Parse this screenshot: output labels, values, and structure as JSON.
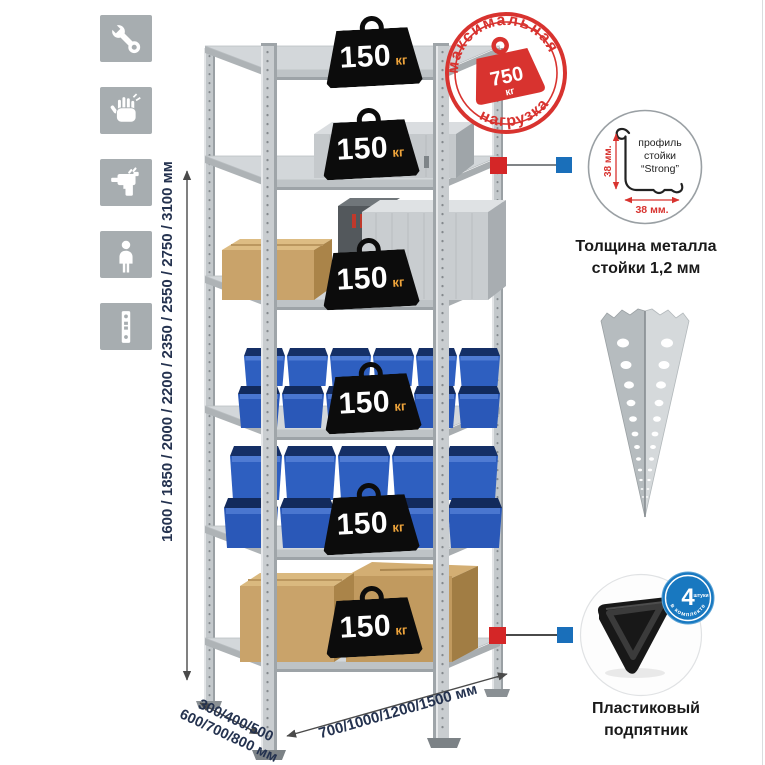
{
  "assembly_icons": [
    {
      "name": "wrench-icon"
    },
    {
      "name": "gloves-icon"
    },
    {
      "name": "drill-icon"
    },
    {
      "name": "person-icon"
    },
    {
      "name": "rack-post-icon"
    }
  ],
  "rack": {
    "shelf_count": 6,
    "shelves": [
      {
        "load_value": "150",
        "load_unit": "кг"
      },
      {
        "load_value": "150",
        "load_unit": "кг"
      },
      {
        "load_value": "150",
        "load_unit": "кг"
      },
      {
        "load_value": "150",
        "load_unit": "кг"
      },
      {
        "load_value": "150",
        "load_unit": "кг"
      },
      {
        "load_value": "150",
        "load_unit": "кг"
      }
    ]
  },
  "max_load_stamp": {
    "arc_top": "максимальная",
    "arc_bottom": "нагрузка",
    "value": "750",
    "unit": "кг"
  },
  "profile_callout": {
    "label_line1": "профиль",
    "label_line2": "стойки",
    "label_line3": "“Strong”",
    "dim_vertical": "38 мм.",
    "dim_horizontal": "38 мм.",
    "caption_line1": "Толщина металла",
    "caption_line2": "стойки 1,2 мм"
  },
  "foot_callout": {
    "badge_count": "4",
    "badge_count_label": "штуки",
    "badge_arc": "в комплекте",
    "caption_line1": "Пластиковый",
    "caption_line2": "подпятник"
  },
  "dimensions": {
    "height": "1600 / 1850 / 2000 / 2200 / 2350 / 2550 / 2750 / 3100 мм",
    "depth_line1": "300/400/500",
    "depth_line2": "600/700/800 мм",
    "width": "700/1000/1200/1500 мм"
  },
  "colors": {
    "stamp_red": "#d8332f",
    "callout_red": "#d42627",
    "callout_blue": "#1a6fba",
    "badge_black": "#0c0c0c",
    "badge_unit_orange": "#eea43b",
    "bin_blue": "#2f62c4",
    "cardboard": "#c9a36a",
    "metal_gray": "#c6cacd",
    "tile_gray": "#a7adb0",
    "label_navy": "#24324f",
    "foot_badge_blue": "#1878c0"
  }
}
